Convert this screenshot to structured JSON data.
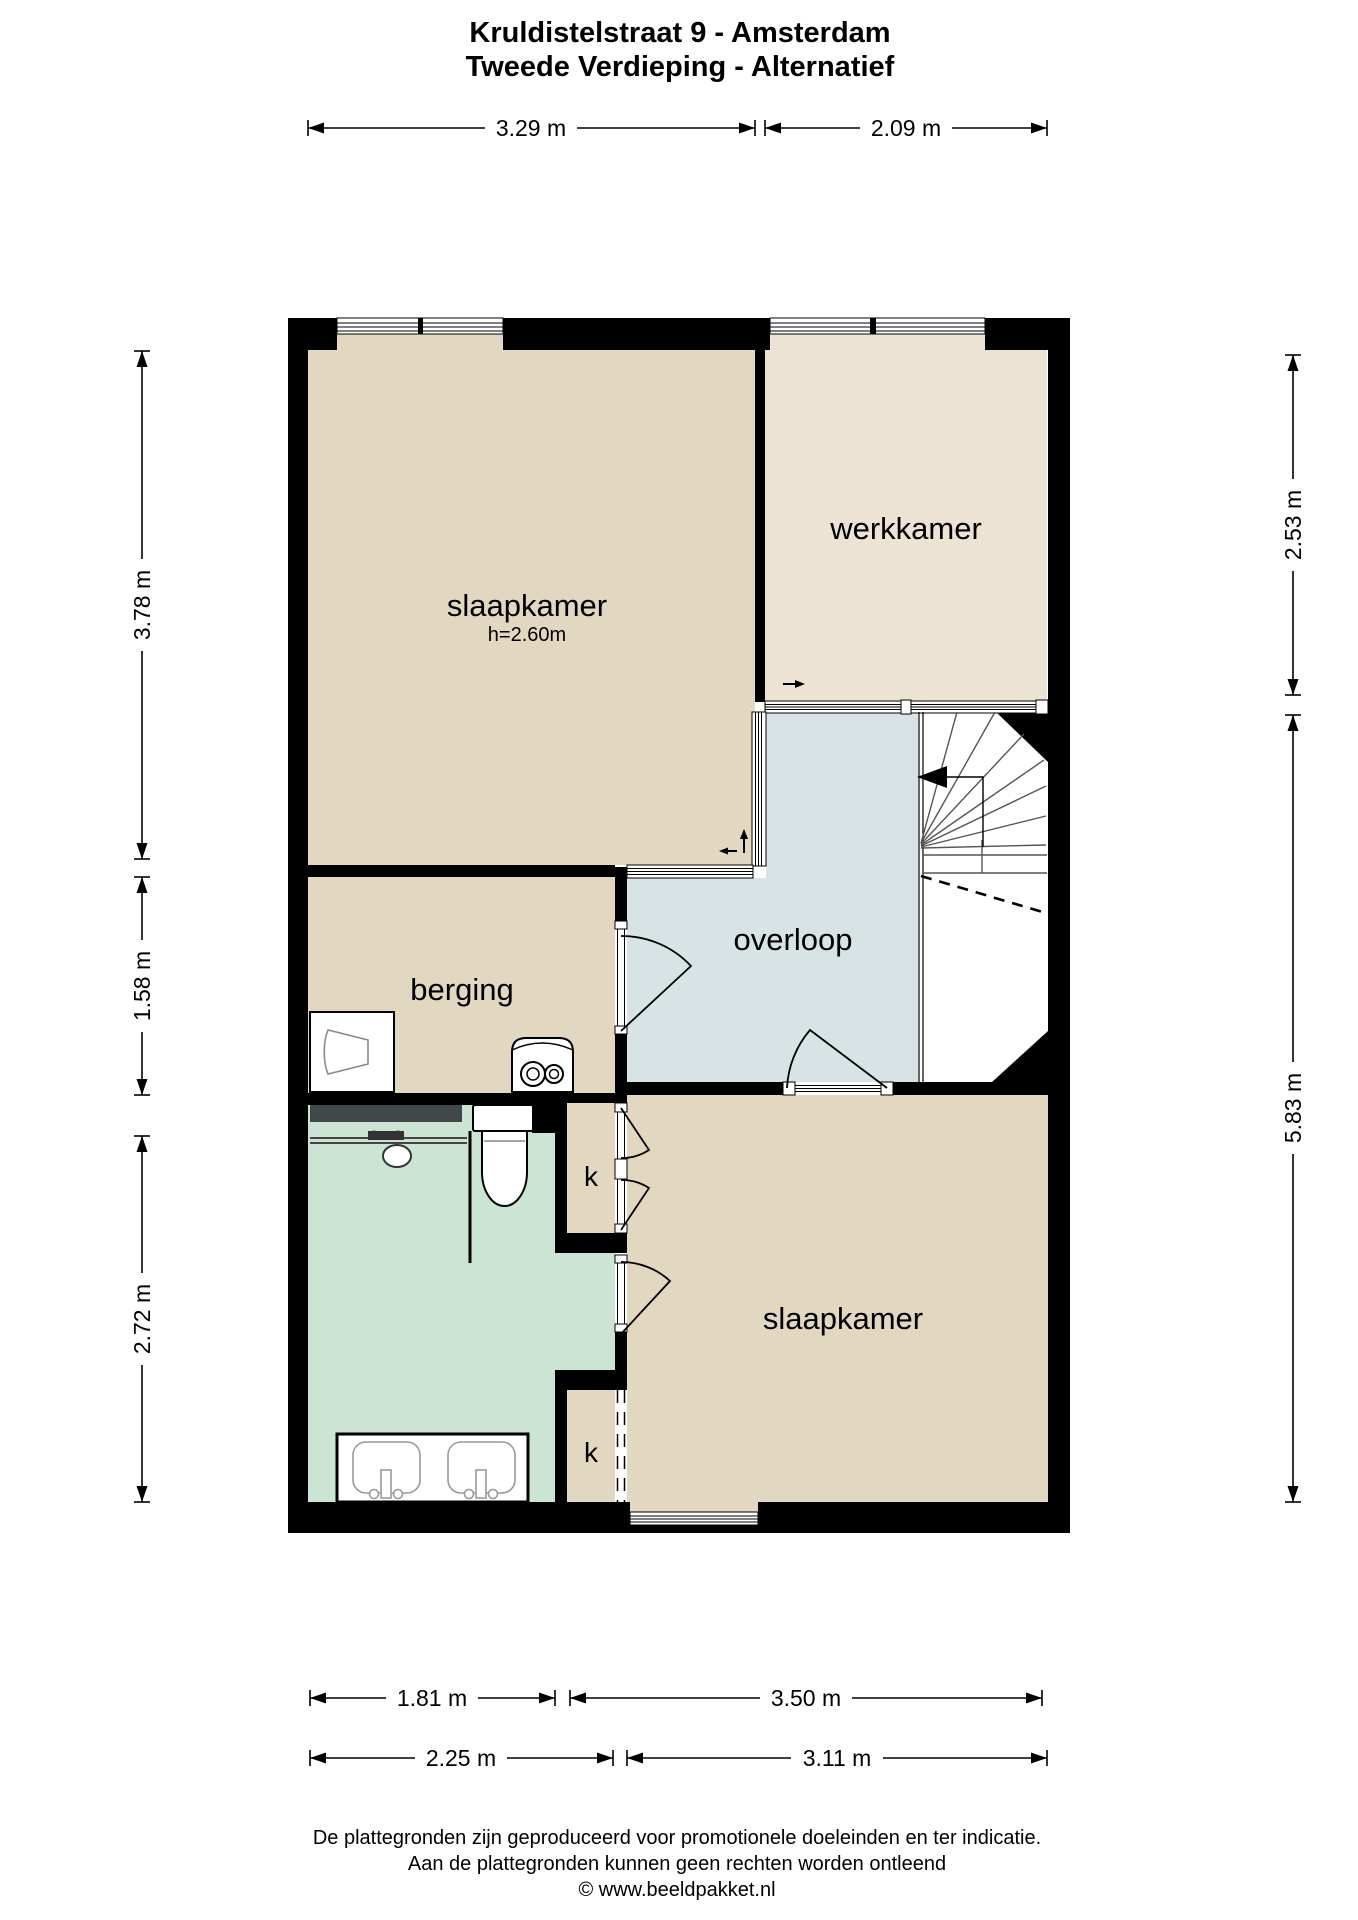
{
  "title": {
    "line1": "Kruldistelstraat 9 - Amsterdam",
    "line2": "Tweede Verdieping - Alternatief"
  },
  "rooms": [
    {
      "name": "slaapkamer-1",
      "label": "slaapkamer",
      "height_note": "h=2.60m"
    },
    {
      "name": "werkkamer",
      "label": "werkkamer"
    },
    {
      "name": "overloop",
      "label": "overloop"
    },
    {
      "name": "berging",
      "label": "berging"
    },
    {
      "name": "slaapkamer-2",
      "label": "slaapkamer"
    },
    {
      "name": "closet-1",
      "label": "k"
    },
    {
      "name": "closet-2",
      "label": "k"
    }
  ],
  "dimensions": {
    "top": [
      {
        "label": "3.29 m"
      },
      {
        "label": "2.09 m"
      }
    ],
    "left": [
      {
        "label": "3.78 m"
      },
      {
        "label": "1.58 m"
      },
      {
        "label": "2.72 m"
      }
    ],
    "right": [
      {
        "label": "2.53 m"
      },
      {
        "label": "5.83 m"
      }
    ],
    "bottom_row1": [
      {
        "label": "1.81 m"
      },
      {
        "label": "3.50 m"
      }
    ],
    "bottom_row2": [
      {
        "label": "2.25 m"
      },
      {
        "label": "3.11 m"
      }
    ]
  },
  "fixtures": [
    "cabinet-icon",
    "boiler-icon",
    "shower-icon",
    "toilet-icon",
    "double-sink-vanity-icon",
    "stairs-icon",
    "stair-direction-arrow-icon",
    "door-swing-icon",
    "window-icon"
  ],
  "footer": {
    "line1": "De plattegronden zijn geproduceerd voor promotionele doeleinden en ter indicatie.",
    "line2": "Aan de plattegronden kunnen geen rechten worden ontleend",
    "line3": "© www.beeldpakket.nl"
  },
  "colors": {
    "floor_tan": "#e2d8c1",
    "floor_beige": "#ece3d5",
    "floor_blue": "#d8e3e6",
    "floor_green": "#cbe4d4",
    "wall": "#000000",
    "shower_bar": "#42474a"
  }
}
